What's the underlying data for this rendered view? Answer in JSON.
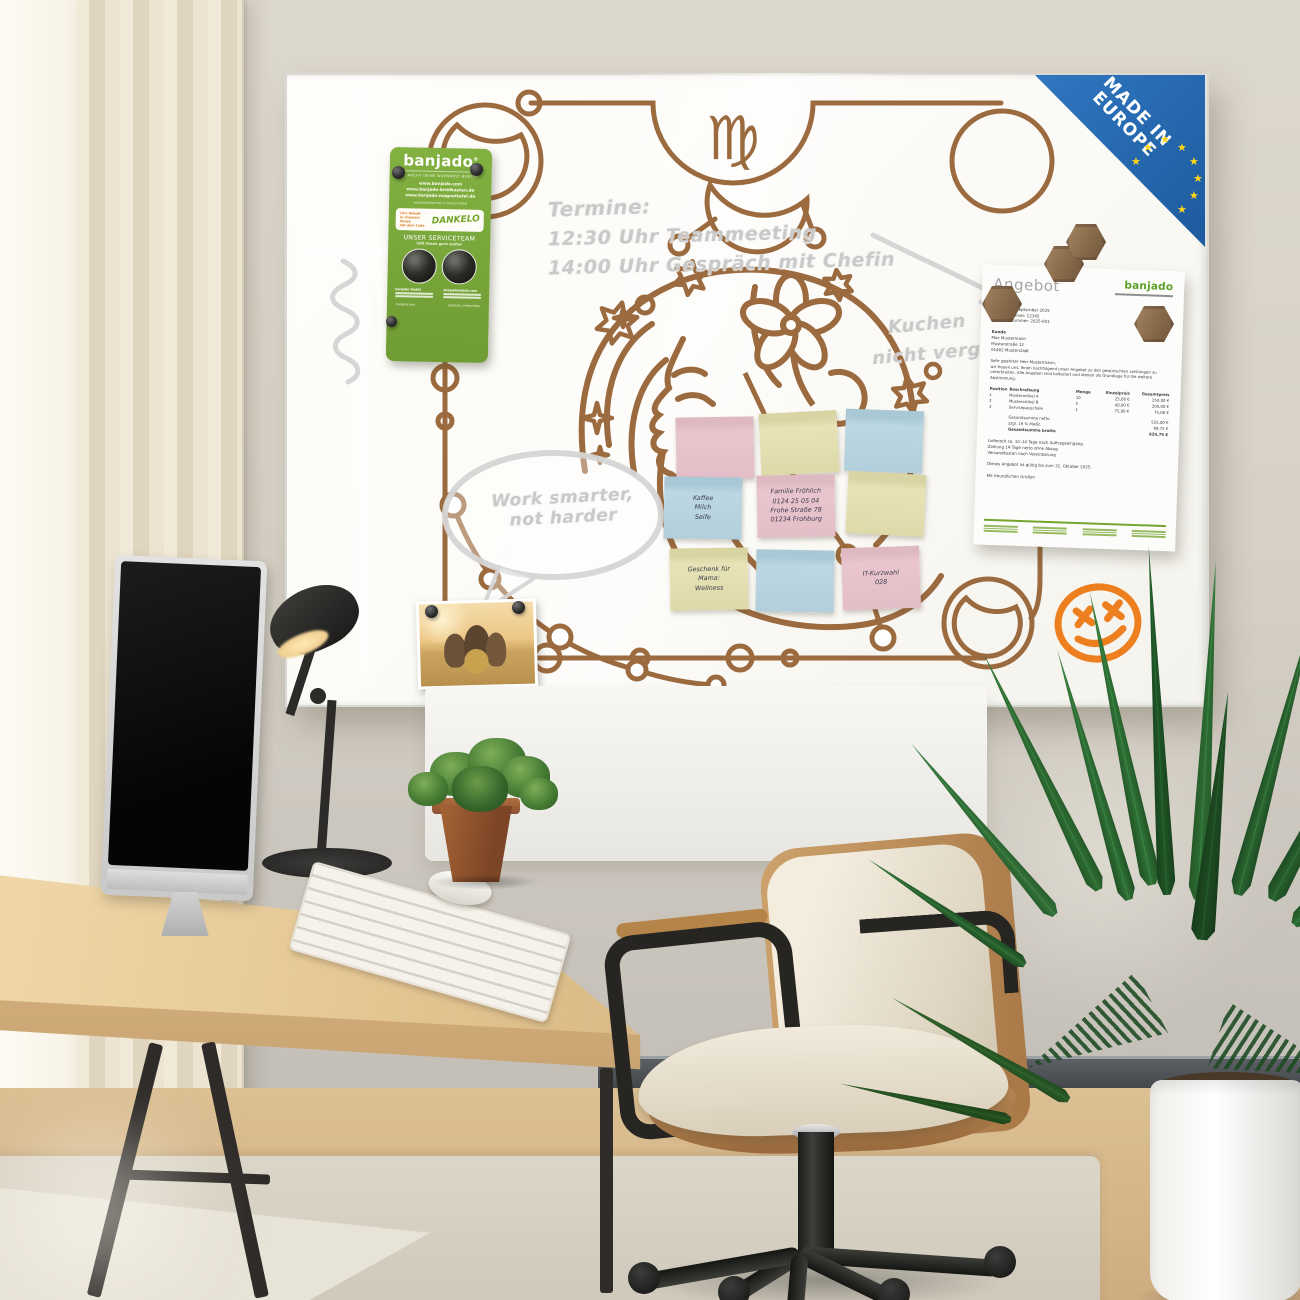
{
  "badge": {
    "line1": "MADE IN",
    "line2": "EUROPE",
    "star": "★"
  },
  "board": {
    "zodiac_symbol": "♍",
    "handwriting": {
      "termine_title": "Termine:",
      "termine_line1": "12:30 Uhr Teammeeting",
      "termine_line2": "14:00 Uhr Gespräch mit Chefin",
      "reminder_line1": "Kuchen",
      "reminder_line2": "nicht vergessen",
      "bubble_line1": "Work smarter,",
      "bubble_line2": "not harder"
    }
  },
  "flyer": {
    "brand": "banjado",
    "reg": "®",
    "tagline": "...MACHT DEINE WOHNWELT BUNTER",
    "urls": [
      "www.banjado.com",
      "www.banjado-briefkasten.de",
      "www.banjado-magnettafel.de"
    ],
    "shipping": "versandkostenfrei in Deutschland",
    "promo": {
      "line1": "15% Rabatt",
      "line2": "in unserem Shops",
      "line3": "mit dem Code",
      "code": "DANKELO"
    },
    "service_title": "UNSER SERVICETEAM",
    "service_sub": "hilft Ihnen gern weiter",
    "contact_left": "banjado GmbH",
    "contact_right": "shop@banjado.com",
    "social_left": "banjado.com",
    "social_right": "banjado_onlineshops"
  },
  "stickies": [
    {
      "color": "pink",
      "lines": []
    },
    {
      "color": "yellow",
      "lines": []
    },
    {
      "color": "blue",
      "lines": []
    },
    {
      "color": "blue",
      "lines": [
        "Kaffee",
        "Milch",
        "Seife"
      ]
    },
    {
      "color": "pink",
      "lines": [
        "Familie Fröhlich",
        "0124 25 05 04",
        "Frohe Straße 78",
        "01234 Frohburg"
      ]
    },
    {
      "color": "yellow",
      "lines": []
    },
    {
      "color": "yellow",
      "lines": [
        "Geschenk für",
        "Mama:",
        "Wellness"
      ]
    },
    {
      "color": "blue",
      "lines": []
    },
    {
      "color": "pink",
      "lines": [
        "IT-Kurzwahl",
        "028"
      ]
    }
  ],
  "document": {
    "title": "Angebot",
    "logo": "banjado",
    "meta": [
      "Angebot",
      "Datum: 23. September 2025",
      "Kundennummer: 12345",
      "Angebotsnummer: 2025-001"
    ],
    "customer": [
      "Kunde",
      "Max Mustermann",
      "Musterstraße 12",
      "01462 Musterstadt"
    ],
    "salutation": "Sehr geehrter Herr Mustermann,",
    "intro": "wir freuen uns, Ihnen nachfolgend unser Angebot zu den gewünschten Leistungen zu unterbreiten. Alle Angaben sind kalkuliert und dienen als Grundlage für die weitere Abstimmung.",
    "table": {
      "headers": [
        "Position",
        "Beschreibung",
        "Menge",
        "Einzelpreis",
        "Gesamtpreis"
      ],
      "rows": [
        [
          "1",
          "Musterartikel A",
          "10",
          "25,00 €",
          "250,00 €"
        ],
        [
          "2",
          "Musterartikel B",
          "5",
          "40,00 €",
          "200,00 €"
        ],
        [
          "3",
          "Servicepauschale",
          "1",
          "75,00 €",
          "75,00 €"
        ]
      ]
    },
    "totals": [
      [
        "Gesamtsumme netto",
        "525,00 €"
      ],
      [
        "zzgl. 19 % MwSt.",
        "99,75 €"
      ],
      [
        "Gesamtsumme brutto",
        "624,75 €"
      ]
    ],
    "terms": [
      "Lieferzeit ca. 10–14 Tage nach Auftragseingang",
      "Zahlung 14 Tage netto ohne Abzug",
      "Versandkosten nach Vereinbarung"
    ],
    "validity": "Dieses Angebot ist gültig bis zum 31. Oktober 2025.",
    "closing": "Mit freundlichen Grüßen"
  },
  "colors": {
    "board_line": "#9b6a3e",
    "marker_grey": "#c9c9c9",
    "flyer_green": "#7aa93c",
    "logo_green": "#5da028",
    "eu_blue": "#2a6db5",
    "eu_star": "#ffd617",
    "smiley_orange": "#ee7f1e",
    "sticky_pink": "#e8c5cd",
    "sticky_yellow": "#e4dfae",
    "sticky_blue": "#b9d5e0"
  }
}
